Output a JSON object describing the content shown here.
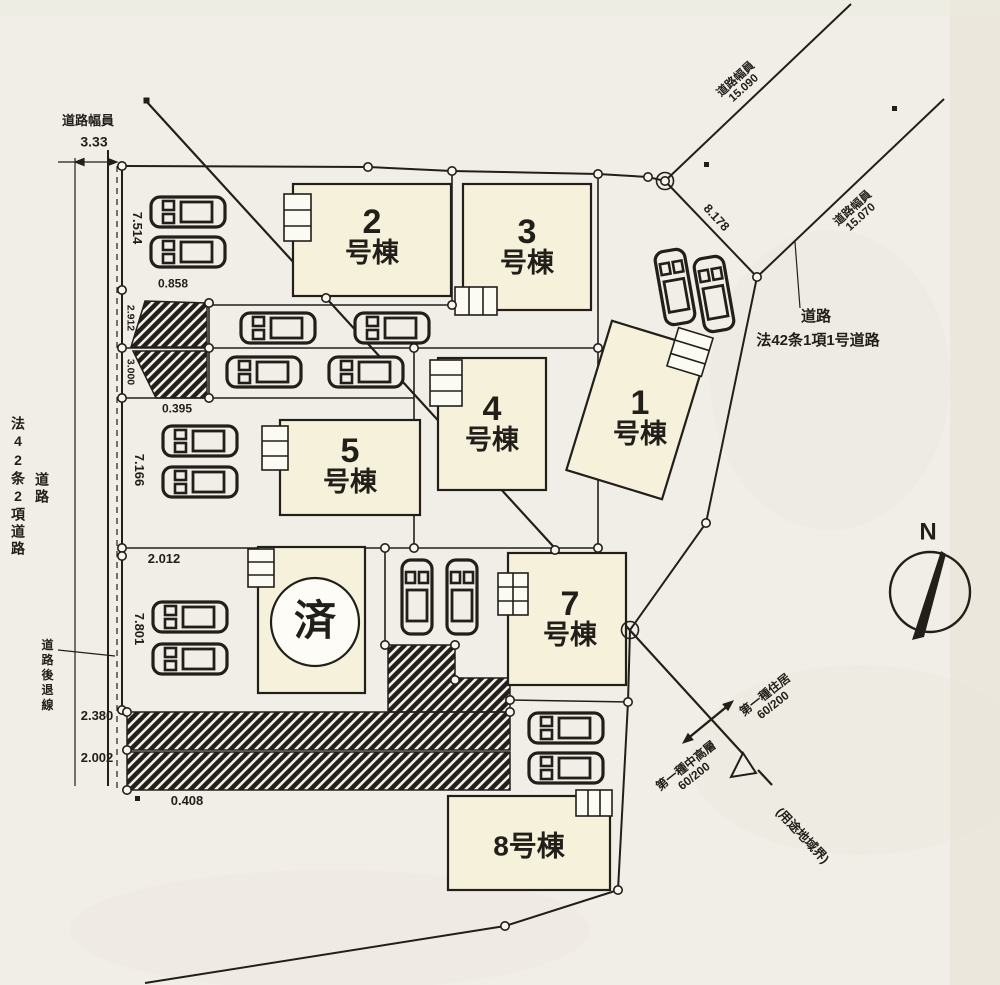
{
  "colors": {
    "paper": "#f1eee7",
    "building_fill": "#f5f1da",
    "line": "#221f1b"
  },
  "left_area": {
    "width_label": "道路幅員",
    "width_value": "3.33",
    "road": "道路",
    "law": "法42条2項道路",
    "setback": "道路後退線"
  },
  "right_road": {
    "road": "道路",
    "law": "法42条1項1号道路",
    "width_label_1": "道路幅員",
    "width_value_1": "15.090",
    "width_label_2": "道路幅員",
    "width_value_2": "15.070",
    "end_width": "8.178"
  },
  "zoning": {
    "zone_a": "第一種住居",
    "zone_a_ratio": "60/200",
    "zone_b": "第一種中高層",
    "zone_b_ratio": "60/200",
    "boundary": "(用途地域界)"
  },
  "compass": {
    "n": "N"
  },
  "buildings": {
    "b1": {
      "no": "1",
      "suffix": "号棟"
    },
    "b2": {
      "no": "2",
      "suffix": "号棟"
    },
    "b3": {
      "no": "3",
      "suffix": "号棟"
    },
    "b4": {
      "no": "4",
      "suffix": "号棟"
    },
    "b5": {
      "no": "5",
      "suffix": "号棟"
    },
    "b7": {
      "no": "7",
      "suffix": "号棟"
    },
    "b8": {
      "label": "8号棟"
    },
    "sold": {
      "label": "済"
    }
  },
  "dims": {
    "d1": "7.514",
    "d2": "0.858",
    "d3": "2.912",
    "d4": "3.000",
    "d5": "0.395",
    "d6": "7.166",
    "d7": "2.012",
    "d8": "7.801",
    "d9": "2.380",
    "d10": "2.002",
    "d11": "0.408"
  }
}
